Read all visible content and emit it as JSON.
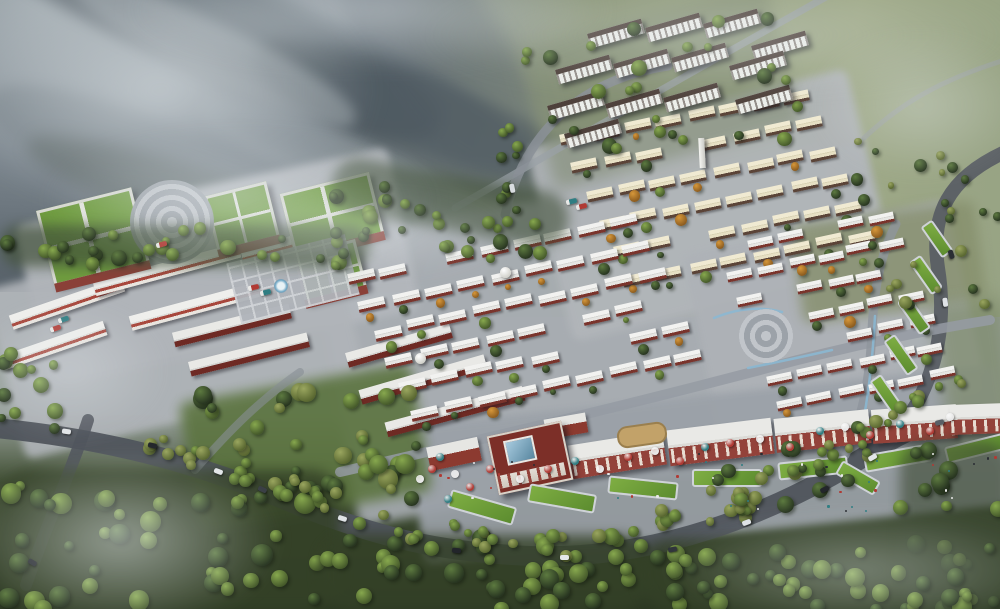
{
  "scene_label": "aerial-town-masterplan-rendering",
  "scene": {
    "palette": {
      "fog_rgb": "228,234,237",
      "road": "#4f545c",
      "road_light": "#9aa1a6",
      "water": "#8ab8d4",
      "trees": {
        "g": [
          "#87a84e",
          "#44582a"
        ],
        "dg": [
          "#5d7a40",
          "#273420"
        ],
        "ol": [
          "#9aa65f",
          "#57652f"
        ],
        "or": [
          "#d6973a",
          "#8a5a1e"
        ]
      },
      "umbrella": {
        "w": "#e8e8e8",
        "r": "#b03a34",
        "t": "#2f7d82"
      },
      "crowd": [
        "#2a2d33",
        "#b03a34",
        "#e8e8e8",
        "#2f7d82"
      ]
    },
    "ridges": [
      [
        -60,
        -30,
        520,
        100,
        24,
        "#49535b",
        0.55,
        7
      ],
      [
        130,
        30,
        430,
        80,
        27,
        "#5d6a72",
        0.5,
        6
      ],
      [
        240,
        85,
        400,
        90,
        23,
        "#434e55",
        0.5,
        7
      ],
      [
        -20,
        115,
        320,
        80,
        20,
        "#6a757c",
        0.45,
        7
      ],
      [
        300,
        -10,
        280,
        130,
        55,
        "#525d65",
        0.4,
        9
      ],
      [
        60,
        25,
        310,
        55,
        26,
        "#9fa8ad",
        0.5,
        6
      ],
      [
        190,
        135,
        300,
        55,
        22,
        "#8d979d",
        0.45,
        6
      ],
      [
        20,
        170,
        360,
        60,
        18,
        "#3f4a42",
        0.35,
        8
      ]
    ],
    "grounds": [
      [
        330,
        190,
        560,
        290,
        -10,
        "#a9aeb4",
        0.9,
        5
      ],
      [
        545,
        105,
        330,
        200,
        -14,
        "#b2b6ba",
        0.9,
        4
      ],
      [
        700,
        225,
        270,
        200,
        -12,
        "#aeb2b7",
        0.9,
        4
      ],
      [
        28,
        185,
        380,
        165,
        -12,
        "#b4b8bd",
        0.92,
        4
      ],
      [
        0,
        245,
        350,
        175,
        -14,
        "#b0b4b9",
        0.9,
        4
      ],
      [
        415,
        395,
        590,
        140,
        -6,
        "#9ba1a8",
        0.92,
        4
      ],
      [
        533,
        14,
        255,
        145,
        -15,
        "#7f8a70",
        0.55,
        7
      ],
      [
        188,
        382,
        235,
        130,
        -10,
        "#5c7440",
        0.9,
        6
      ],
      [
        796,
        212,
        185,
        100,
        -8,
        "#868f6c",
        0.8,
        6
      ],
      [
        940,
        300,
        70,
        140,
        -8,
        "#7d8a6a",
        0.7,
        8
      ]
    ],
    "roads": [
      [
        "M-5,428 C120,440 210,468 300,506 C380,538 440,552 530,556 C650,560 770,518 878,448 C918,422 958,412 1005,418",
        20,
        "#4f545c",
        0.95
      ],
      [
        "M88,420 C72,470 48,520 26,585",
        12,
        "#4f545c",
        0.85
      ],
      [
        "M884,446 C934,398 948,330 938,268 C930,215 948,178 1005,152",
        14,
        "#565b63",
        0.9
      ],
      [
        "M455,208 C560,148 680,78 835,-8",
        7,
        "#9aa1a6",
        0.7
      ],
      [
        "M1005,60 C940,80 900,104 864,138",
        5,
        "#9aa1a6",
        0.55
      ],
      [
        "M505,215 C516,168 540,125 585,96 C610,80 640,70 668,66",
        9,
        "#8b9198",
        0.85
      ],
      [
        "M340,472 C480,440 620,407 760,370 C840,348 915,332 990,320",
        10,
        "#959ba3",
        0.85
      ],
      [
        "M845,455 C862,420 870,380 872,330 C874,290 880,255 896,224",
        9,
        "#8f959c",
        0.8
      ],
      [
        "M195,470 C230,430 260,400 300,372",
        8,
        "#878d95",
        0.6
      ]
    ],
    "water": [
      "M714,318 C738,308 760,306 782,312",
      "M748,368 C778,362 806,356 832,350",
      "M862,428 C869,392 873,354 875,316"
    ],
    "villages": [
      {
        "o": [
          560,
          133
        ],
        "u": [
          32,
          -6
        ],
        "v": [
          13,
          28
        ],
        "cols": 8,
        "rows": 6,
        "w": 26,
        "h": 11,
        "angle": -12,
        "roof": "cream",
        "skip": 0.08,
        "tree": 0.5,
        "holes": [
          [
            703,
            150,
            12
          ]
        ]
      },
      {
        "o": [
          347,
          272
        ],
        "u": [
          33,
          -7
        ],
        "v": [
          13,
          27
        ],
        "cols": 9,
        "rows": 6,
        "w": 27,
        "h": 11,
        "angle": -13,
        "roof": "white",
        "skip": 0.1,
        "tree": 0.5,
        "holes": []
      },
      {
        "o": [
          718,
          243
        ],
        "u": [
          30,
          -6
        ],
        "v": [
          10,
          26
        ],
        "cols": 6,
        "rows": 7,
        "w": 25,
        "h": 10,
        "angle": -12,
        "roof": "white",
        "skip": 0.1,
        "tree": 0.45,
        "holes": [
          [
            766,
            336,
            36
          ]
        ]
      }
    ],
    "rows": [
      [
        8,
        296,
        118,
        -19,
        "rw"
      ],
      [
        0,
        338,
        108,
        -19,
        "rw"
      ],
      [
        92,
        262,
        150,
        -15,
        "rw"
      ],
      [
        128,
        296,
        155,
        -15,
        "rw"
      ],
      [
        240,
        234,
        118,
        -15,
        "rw"
      ],
      [
        172,
        318,
        120,
        -14,
        "dr"
      ],
      [
        188,
        347,
        122,
        -14,
        "dr"
      ],
      [
        345,
        338,
        108,
        -16,
        "dr"
      ],
      [
        358,
        372,
        130,
        -16,
        "dr"
      ],
      [
        384,
        404,
        142,
        -15,
        "dr"
      ]
    ],
    "apartments": {
      "w": 56,
      "h": 15,
      "angle": -16,
      "slabs": [
        [
          588,
          26
        ],
        [
          646,
          20
        ],
        [
          704,
          16
        ],
        [
          752,
          38
        ],
        [
          556,
          62
        ],
        [
          614,
          56
        ],
        [
          672,
          50
        ],
        [
          730,
          58
        ],
        [
          548,
          98
        ],
        [
          606,
          96
        ],
        [
          664,
          90
        ],
        [
          565,
          126
        ],
        [
          736,
          92
        ]
      ]
    },
    "school": {
      "buildings": [
        [
          44,
          198,
          92,
          72,
          -14
        ],
        [
          210,
          188,
          58,
          52,
          -14
        ],
        [
          286,
          182,
          86,
          58,
          -14
        ],
        [
          298,
          246,
          58,
          44,
          -14
        ]
      ],
      "plazaRings": [
        172,
        222,
        42
      ],
      "plazaGrid": [
        232,
        248,
        122,
        62,
        -14
      ],
      "fountain": [
        281,
        286
      ]
    },
    "plazaRight": [
      766,
      336,
      27
    ],
    "tower": [
      699,
      138
    ],
    "domes": [
      [
        505,
        272
      ],
      [
        420,
        358
      ]
    ],
    "commercial": {
      "arcades": [
        [
          570,
          438,
          95,
          34,
          -9
        ],
        [
          668,
          424,
          105,
          36,
          -7
        ],
        [
          775,
          414,
          95,
          34,
          -6
        ],
        [
          872,
          407,
          85,
          34,
          -4
        ],
        [
          950,
          404,
          58,
          30,
          -2
        ]
      ],
      "landmark": [
        492,
        428,
        72,
        56,
        -12
      ],
      "shops": [
        [
          545,
          416,
          42,
          20,
          -10
        ],
        [
          428,
          442,
          52,
          24,
          -12
        ]
      ],
      "courtyard": [
        617,
        424,
        46,
        18,
        -8
      ],
      "lawns": [
        [
          448,
          498,
          64,
          15,
          16
        ],
        [
          528,
          489,
          64,
          15,
          10
        ],
        [
          608,
          479,
          66,
          14,
          6
        ],
        [
          692,
          469,
          66,
          14,
          0
        ],
        [
          778,
          459,
          66,
          14,
          -6
        ],
        [
          864,
          449,
          64,
          14,
          -10
        ],
        [
          945,
          440,
          56,
          13,
          -14
        ]
      ],
      "umbrellas": [
        [
          455,
          474,
          "w"
        ],
        [
          470,
          487,
          "r"
        ],
        [
          448,
          499,
          "t"
        ],
        [
          490,
          469,
          "r"
        ],
        [
          520,
          479,
          "w"
        ],
        [
          548,
          469,
          "r"
        ],
        [
          575,
          461,
          "t"
        ],
        [
          600,
          469,
          "w"
        ],
        [
          628,
          457,
          "r"
        ],
        [
          655,
          451,
          "w"
        ],
        [
          680,
          461,
          "r"
        ],
        [
          705,
          447,
          "t"
        ],
        [
          730,
          443,
          "r"
        ],
        [
          760,
          439,
          "w"
        ],
        [
          790,
          447,
          "r"
        ],
        [
          820,
          431,
          "t"
        ],
        [
          845,
          427,
          "w"
        ],
        [
          870,
          435,
          "r"
        ],
        [
          900,
          424,
          "t"
        ],
        [
          930,
          431,
          "r"
        ],
        [
          950,
          417,
          "w"
        ],
        [
          432,
          469,
          "r"
        ],
        [
          440,
          457,
          "t"
        ],
        [
          420,
          479,
          "w"
        ]
      ],
      "crowd": [
        432,
        452,
        565,
        58,
        42
      ]
    },
    "lawnsRight": [
      [
        866,
        388,
        38,
        10,
        55
      ],
      [
        880,
        348,
        38,
        10,
        55
      ],
      [
        894,
        308,
        36,
        10,
        55
      ],
      [
        906,
        268,
        36,
        10,
        55
      ],
      [
        918,
        232,
        34,
        10,
        55
      ],
      [
        836,
        470,
        40,
        12,
        30
      ]
    ],
    "tree_bands": [
      [
        0,
        470,
        340,
        140,
        0,
        48,
        5,
        11,
        [
          "dg",
          "g"
        ],
        "#344127",
        0.85
      ],
      [
        320,
        535,
        330,
        75,
        0,
        40,
        5,
        10,
        [
          "dg",
          "g"
        ],
        "#344127",
        0.8
      ],
      [
        640,
        540,
        370,
        70,
        0,
        42,
        5,
        10,
        [
          "dg",
          "g"
        ],
        "#344127",
        0.8
      ],
      [
        700,
        470,
        170,
        60,
        -15,
        16,
        4,
        9,
        [
          "dg",
          "ol"
        ],
        null,
        0
      ],
      [
        900,
        440,
        110,
        170,
        0,
        20,
        5,
        10,
        [
          "dg",
          "g"
        ],
        "#3a4730",
        0.6
      ],
      [
        0,
        225,
        370,
        42,
        0,
        30,
        4,
        8,
        [
          "dg",
          "g"
        ],
        "#42513a",
        0.7
      ],
      [
        330,
        175,
        240,
        55,
        10,
        26,
        4,
        8,
        [
          "dg",
          "g"
        ],
        "#42513a",
        0.6
      ],
      [
        520,
        12,
        270,
        140,
        0,
        26,
        4,
        8,
        [
          "g",
          "dg"
        ],
        null,
        0
      ],
      [
        840,
        140,
        160,
        170,
        0,
        26,
        3,
        7,
        [
          "ol",
          "dg"
        ],
        null,
        0
      ],
      [
        0,
        330,
        60,
        110,
        0,
        12,
        4,
        8,
        [
          "g",
          "dg"
        ],
        null,
        0
      ],
      [
        195,
        390,
        225,
        118,
        0,
        34,
        5,
        10,
        [
          "g",
          "dg",
          "ol"
        ],
        null,
        0
      ],
      [
        140,
        424,
        170,
        26,
        18,
        16,
        4,
        7,
        [
          "ol",
          "g"
        ],
        null,
        0
      ],
      [
        285,
        472,
        150,
        24,
        22,
        14,
        4,
        7,
        [
          "ol",
          "g"
        ],
        null,
        0
      ],
      [
        420,
        516,
        170,
        22,
        8,
        15,
        4,
        7,
        [
          "ol",
          "g"
        ],
        null,
        0
      ],
      [
        595,
        522,
        170,
        22,
        -10,
        15,
        4,
        7,
        [
          "ol",
          "g"
        ],
        null,
        0
      ],
      [
        725,
        487,
        160,
        22,
        -22,
        14,
        4,
        7,
        [
          "ol",
          "g"
        ],
        null,
        0
      ],
      [
        852,
        428,
        120,
        20,
        -30,
        11,
        4,
        7,
        [
          "ol",
          "g"
        ],
        null,
        0
      ],
      [
        498,
        128,
        22,
        85,
        0,
        8,
        3,
        6,
        [
          "g",
          "dg"
        ],
        null,
        0
      ]
    ],
    "cars": [
      [
        62,
        429,
        8,
        "#e2e5e7"
      ],
      [
        148,
        443,
        14,
        "#23262b"
      ],
      [
        214,
        469,
        20,
        "#e4e7e9"
      ],
      [
        258,
        487,
        24,
        "#3a3f45"
      ],
      [
        338,
        516,
        18,
        "#dfe3e6"
      ],
      [
        452,
        548,
        6,
        "#22252a"
      ],
      [
        560,
        555,
        0,
        "#e4e7e9"
      ],
      [
        668,
        547,
        -10,
        "#30343a"
      ],
      [
        742,
        520,
        -20,
        "#dfe3e6"
      ],
      [
        820,
        487,
        -28,
        "#23262b"
      ],
      [
        868,
        455,
        -30,
        "#e2e5e7"
      ],
      [
        935,
        420,
        -14,
        "#595f66"
      ],
      [
        941,
        300,
        82,
        "#dfe3e6"
      ],
      [
        947,
        252,
        72,
        "#2a2e33"
      ],
      [
        508,
        186,
        78,
        "#d9dce0"
      ],
      [
        28,
        560,
        30,
        "#23262b"
      ]
    ],
    "trucks": [
      [
        248,
        285,
        -14,
        "#b03a34"
      ],
      [
        260,
        290,
        -14,
        "#2f7d82"
      ],
      [
        156,
        242,
        -15,
        "#b03a34"
      ],
      [
        58,
        317,
        -19,
        "#2f7d82"
      ],
      [
        50,
        326,
        -19,
        "#b03a34"
      ],
      [
        566,
        199,
        -14,
        "#2f7d82"
      ],
      [
        576,
        204,
        -14,
        "#b03a34"
      ]
    ],
    "fog": [
      [
        -60,
        -40,
        440,
        260,
        0.6
      ],
      [
        40,
        130,
        400,
        140,
        0.5
      ],
      [
        410,
        -30,
        620,
        130,
        0.34
      ],
      [
        -40,
        450,
        320,
        180,
        0.55
      ],
      [
        660,
        510,
        400,
        120,
        0.4
      ],
      [
        810,
        30,
        220,
        150,
        0.36
      ],
      [
        230,
        195,
        280,
        80,
        0.38
      ],
      [
        -30,
        300,
        200,
        140,
        0.35
      ],
      [
        120,
        -50,
        500,
        120,
        0.5
      ]
    ]
  }
}
